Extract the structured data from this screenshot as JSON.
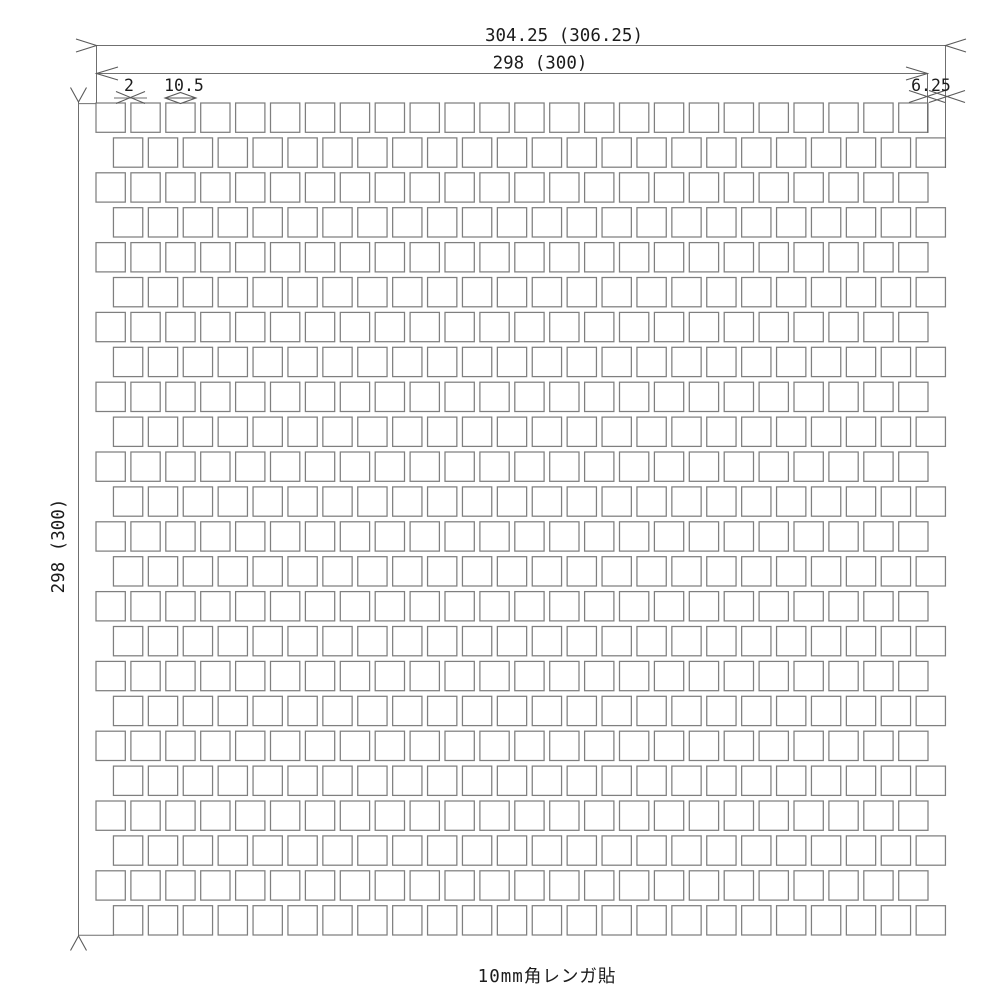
{
  "drawing": {
    "caption": "10mm角レンガ貼",
    "dim_overall_width": "304.25 (306.25)",
    "dim_sheet_width": "298 (300)",
    "dim_sheet_height": "298 (300)",
    "dim_joint": "2",
    "dim_tile": "10.5",
    "dim_row_offset": "6.25",
    "grid": {
      "rows": 24,
      "cols": 24
    },
    "colors": {
      "background": "#ffffff",
      "tile_fill": "#ffffff",
      "tile_border": "#7f7f7f",
      "dim_line": "#6f6f6f",
      "marker": "#5a5a5a",
      "text": "#1c1c1c"
    }
  }
}
